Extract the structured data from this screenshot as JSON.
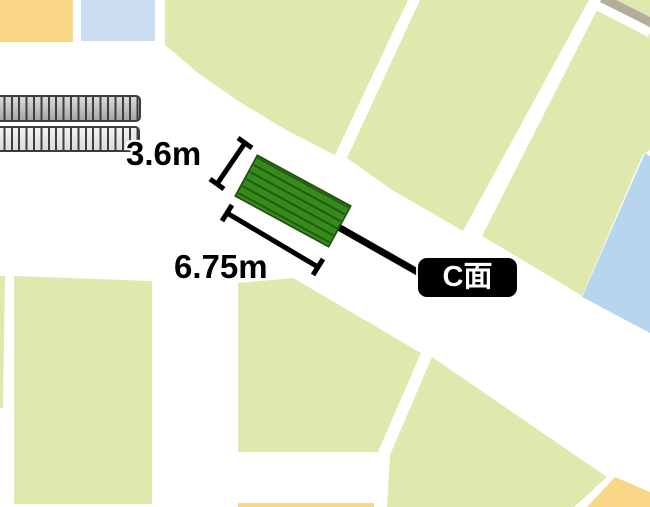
{
  "map": {
    "annotation": {
      "width_label": "3.6m",
      "length_label": "6.75m",
      "face_label": "C面"
    },
    "colors": {
      "road": "#ffffff",
      "parcel_green": "#dfe9ad",
      "block_orange": "#fad687",
      "block_blue": "#cadcf0",
      "water_blue": "#b7d5ed",
      "path_band": "#b4ac9c",
      "sign_green": "#378a1c",
      "sign_hatch": "#1f5c0d",
      "annotation_black": "#000000"
    }
  }
}
